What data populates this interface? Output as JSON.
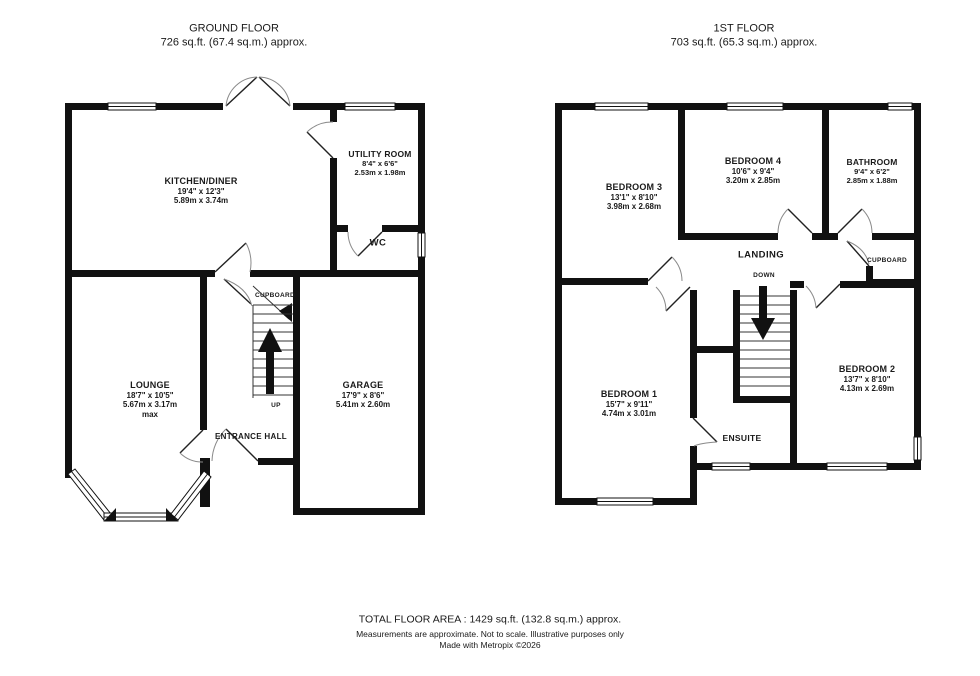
{
  "header": {
    "ground_floor": {
      "title": "GROUND FLOOR",
      "area": "726 sq.ft. (67.4 sq.m.) approx."
    },
    "first_floor": {
      "title": "1ST FLOOR",
      "area": "703 sq.ft. (65.3 sq.m.) approx."
    }
  },
  "ground_floor": {
    "rooms": {
      "kitchen_diner": {
        "name": "KITCHEN/DINER",
        "imperial": "19'4\" x 12'3\"",
        "metric": "5.89m x 3.74m"
      },
      "utility_room": {
        "name": "UTILITY ROOM",
        "imperial": "8'4\" x 6'6\"",
        "metric": "2.53m x 1.98m"
      },
      "wc": {
        "name": "WC"
      },
      "cupboard": {
        "name": "CUPBOARD"
      },
      "lounge": {
        "name": "LOUNGE",
        "imperial": "18'7\" x 10'5\"",
        "metric": "5.67m x 3.17m",
        "note": "max"
      },
      "entrance_hall": {
        "name": "ENTRANCE HALL"
      },
      "garage": {
        "name": "GARAGE",
        "imperial": "17'9\" x 8'6\"",
        "metric": "5.41m x 2.60m"
      }
    },
    "stairs_label": "UP"
  },
  "first_floor": {
    "rooms": {
      "bedroom_3": {
        "name": "BEDROOM 3",
        "imperial": "13'1\" x 8'10\"",
        "metric": "3.98m x 2.68m"
      },
      "bedroom_4": {
        "name": "BEDROOM 4",
        "imperial": "10'6\" x 9'4\"",
        "metric": "3.20m x 2.85m"
      },
      "bathroom": {
        "name": "BATHROOM",
        "imperial": "9'4\" x 6'2\"",
        "metric": "2.85m x 1.88m"
      },
      "landing": {
        "name": "LANDING"
      },
      "cupboard": {
        "name": "CUPBOARD"
      },
      "bedroom_1": {
        "name": "BEDROOM 1",
        "imperial": "15'7\" x 9'11\"",
        "metric": "4.74m x 3.01m"
      },
      "ensuite": {
        "name": "ENSUITE"
      },
      "bedroom_2": {
        "name": "BEDROOM 2",
        "imperial": "13'7\" x 8'10\"",
        "metric": "4.13m x 2.69m"
      }
    },
    "stairs_label": "DOWN"
  },
  "footer": {
    "total_area": "TOTAL FLOOR AREA : 1429 sq.ft. (132.8 sq.m.) approx.",
    "disclaimer": "Measurements are approximate.  Not to scale.  Illustrative purposes only",
    "credit": "Made with Metropix ©2026"
  },
  "colors": {
    "wall": "#111111",
    "background": "#ffffff",
    "text": "#1a1a1a",
    "door_arc": "#8a8a8a"
  }
}
